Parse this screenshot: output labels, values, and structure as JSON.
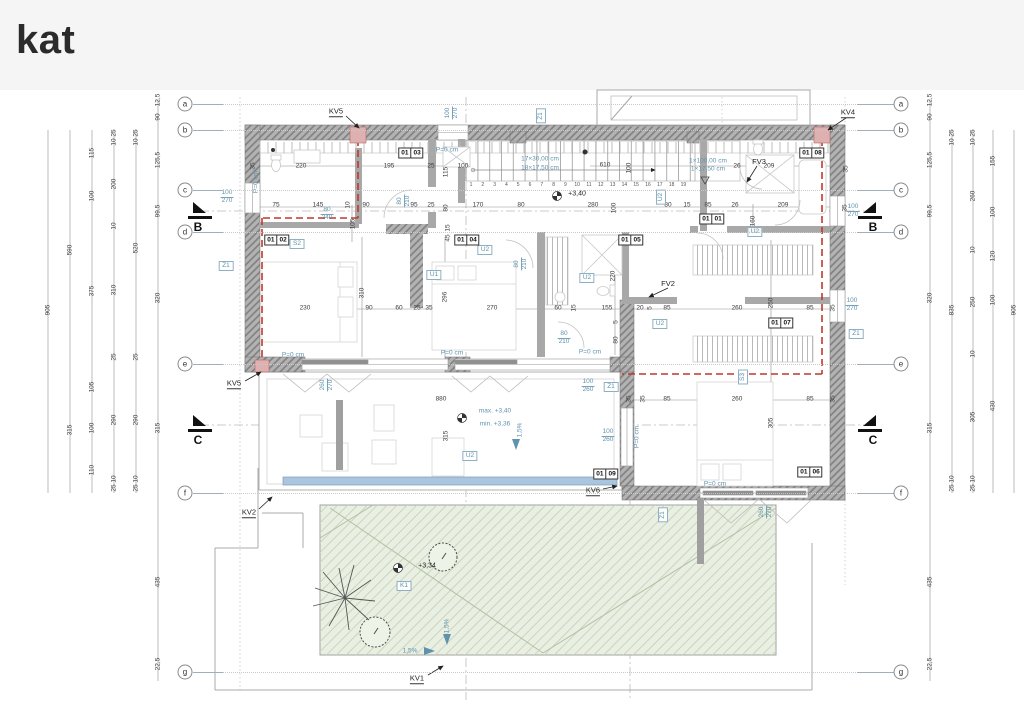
{
  "title": "kat",
  "colors": {
    "accent_blue": "#5f93ad",
    "red_dashed": "#c0392b",
    "green_roof": "#e9efe2",
    "glass_strip": "#aac6df",
    "wall_gray": "#b3b3b3"
  },
  "grid": {
    "rows": [
      {
        "l": "a",
        "y": 104
      },
      {
        "l": "b",
        "y": 130
      },
      {
        "l": "c",
        "y": 190
      },
      {
        "l": "d",
        "y": 232
      },
      {
        "l": "e",
        "y": 364
      },
      {
        "l": "f",
        "y": 493
      },
      {
        "l": "g",
        "y": 672
      }
    ],
    "left_x": 185,
    "right_x": 901
  },
  "stairs": {
    "numbers": [
      "1",
      "2",
      "3",
      "4",
      "5",
      "6",
      "7",
      "8",
      "9",
      "10",
      "11",
      "12",
      "13",
      "14",
      "15",
      "16",
      "17",
      "18",
      "19"
    ],
    "x0": 471,
    "dx": 11.8,
    "y": 185
  },
  "annotations": {
    "dims": [
      [
        "905",
        48,
        310,
        1
      ],
      [
        "590",
        70,
        250,
        1
      ],
      [
        "315",
        70,
        430,
        1
      ],
      [
        "115",
        92,
        153,
        1
      ],
      [
        "100",
        92,
        196,
        1
      ],
      [
        "375",
        92,
        291,
        1
      ],
      [
        "105",
        92,
        387,
        1
      ],
      [
        "100",
        92,
        428,
        1
      ],
      [
        "110",
        92,
        470,
        1
      ],
      [
        "25",
        114,
        133,
        1
      ],
      [
        "10",
        114,
        142,
        1
      ],
      [
        "200",
        114,
        184,
        1
      ],
      [
        "10",
        114,
        226,
        1
      ],
      [
        "310",
        114,
        290,
        1
      ],
      [
        "25",
        114,
        357,
        1
      ],
      [
        "290",
        114,
        420,
        1
      ],
      [
        "10",
        114,
        479,
        1
      ],
      [
        "25",
        114,
        488,
        1
      ],
      [
        "25",
        136,
        133,
        1
      ],
      [
        "10",
        136,
        142,
        1
      ],
      [
        "520",
        136,
        248,
        1
      ],
      [
        "25",
        136,
        357,
        1
      ],
      [
        "290",
        136,
        420,
        1
      ],
      [
        "10",
        136,
        479,
        1
      ],
      [
        "25",
        136,
        488,
        1
      ],
      [
        "12,5",
        158,
        100,
        1
      ],
      [
        "90",
        158,
        117,
        1
      ],
      [
        "125,5",
        158,
        160,
        1
      ],
      [
        "99,5",
        158,
        211,
        1
      ],
      [
        "320",
        158,
        298,
        1
      ],
      [
        "315",
        158,
        428,
        1
      ],
      [
        "435",
        158,
        582,
        1
      ],
      [
        "22,5",
        158,
        664,
        1
      ],
      [
        "12,5",
        930,
        100,
        1
      ],
      [
        "90",
        930,
        117,
        1
      ],
      [
        "125,5",
        930,
        160,
        1
      ],
      [
        "99,5",
        930,
        211,
        1
      ],
      [
        "320",
        930,
        298,
        1
      ],
      [
        "315",
        930,
        428,
        1
      ],
      [
        "435",
        930,
        582,
        1
      ],
      [
        "22,5",
        930,
        664,
        1
      ],
      [
        "25",
        952,
        133,
        1
      ],
      [
        "10",
        952,
        142,
        1
      ],
      [
        "835",
        952,
        310,
        1
      ],
      [
        "10",
        952,
        479,
        1
      ],
      [
        "25",
        952,
        488,
        1
      ],
      [
        "25",
        973,
        133,
        1
      ],
      [
        "10",
        973,
        142,
        1
      ],
      [
        "260",
        973,
        196,
        1
      ],
      [
        "10",
        973,
        250,
        1
      ],
      [
        "250",
        973,
        302,
        1
      ],
      [
        "10",
        973,
        354,
        1
      ],
      [
        "305",
        973,
        417,
        1
      ],
      [
        "10",
        973,
        479,
        1
      ],
      [
        "25",
        973,
        488,
        1
      ],
      [
        "155",
        993,
        161,
        1
      ],
      [
        "100",
        993,
        212,
        1
      ],
      [
        "120",
        993,
        256,
        1
      ],
      [
        "100",
        993,
        300,
        1
      ],
      [
        "430",
        993,
        406,
        1
      ],
      [
        "905",
        1014,
        310,
        1
      ],
      [
        "35",
        253,
        166,
        1
      ],
      [
        "220",
        301,
        166,
        0
      ],
      [
        "195",
        389,
        166,
        0
      ],
      [
        "25",
        431,
        166,
        0
      ],
      [
        "115",
        446,
        172,
        1
      ],
      [
        "100",
        463,
        166,
        0
      ],
      [
        "610",
        605,
        165,
        0
      ],
      [
        "100",
        629,
        168,
        1
      ],
      [
        "26",
        737,
        166,
        0
      ],
      [
        "209",
        769,
        166,
        0
      ],
      [
        "35",
        846,
        169,
        1
      ],
      [
        "75",
        276,
        205,
        0
      ],
      [
        "145",
        318,
        205,
        0
      ],
      [
        "10",
        348,
        205,
        1
      ],
      [
        "90",
        366,
        205,
        0
      ],
      [
        "95",
        414,
        205,
        0
      ],
      [
        "25",
        431,
        205,
        0
      ],
      [
        "80",
        446,
        208,
        1
      ],
      [
        "170",
        478,
        205,
        0
      ],
      [
        "80",
        521,
        205,
        0
      ],
      [
        "280",
        593,
        205,
        0
      ],
      [
        "100",
        614,
        208,
        1
      ],
      [
        "80",
        668,
        205,
        0
      ],
      [
        "15",
        687,
        205,
        0
      ],
      [
        "85",
        708,
        205,
        0
      ],
      [
        "26",
        735,
        205,
        0
      ],
      [
        "209",
        783,
        205,
        0
      ],
      [
        "35",
        845,
        208,
        1
      ],
      [
        "160",
        753,
        221,
        1
      ],
      [
        "105",
        353,
        224,
        1
      ],
      [
        "15",
        448,
        228,
        1
      ],
      [
        "45",
        448,
        238,
        1
      ],
      [
        "220",
        613,
        276,
        1
      ],
      [
        "296",
        445,
        297,
        1
      ],
      [
        "310",
        362,
        293,
        1
      ],
      [
        "250",
        771,
        303,
        1
      ],
      [
        "5",
        616,
        322,
        1
      ],
      [
        "80",
        616,
        340,
        1
      ],
      [
        "305",
        771,
        423,
        1
      ],
      [
        "315",
        446,
        436,
        1
      ],
      [
        "230",
        305,
        308,
        0
      ],
      [
        "90",
        369,
        308,
        0
      ],
      [
        "60",
        399,
        308,
        0
      ],
      [
        "25",
        417,
        308,
        0
      ],
      [
        "35",
        429,
        308,
        0
      ],
      [
        "270",
        492,
        308,
        0
      ],
      [
        "60",
        558,
        308,
        0
      ],
      [
        "15",
        574,
        308,
        1
      ],
      [
        "155",
        607,
        308,
        0
      ],
      [
        "20",
        640,
        308,
        0
      ],
      [
        "5",
        650,
        308,
        1
      ],
      [
        "85",
        667,
        308,
        0
      ],
      [
        "260",
        737,
        308,
        0
      ],
      [
        "85",
        810,
        308,
        0
      ],
      [
        "35",
        833,
        308,
        1
      ],
      [
        "880",
        441,
        399,
        0
      ],
      [
        "35",
        629,
        399,
        1
      ],
      [
        "35",
        643,
        399,
        1
      ],
      [
        "85",
        667,
        399,
        0
      ],
      [
        "260",
        737,
        399,
        0
      ],
      [
        "85",
        810,
        399,
        0
      ],
      [
        "35",
        833,
        399,
        1
      ]
    ],
    "blue_fracs": [
      [
        "100",
        "270",
        227,
        197,
        0
      ],
      [
        "100",
        "270",
        452,
        113,
        1
      ],
      [
        "100",
        "270",
        853,
        211,
        0
      ],
      [
        "100",
        "270",
        852,
        305,
        0
      ],
      [
        "100",
        "260",
        588,
        386,
        0
      ],
      [
        "100",
        "260",
        608,
        436,
        0
      ],
      [
        "80",
        "210",
        404,
        201,
        1
      ],
      [
        "80",
        "210",
        521,
        264,
        1
      ],
      [
        "80",
        "210",
        564,
        338,
        0
      ],
      [
        "80",
        "240",
        327,
        214,
        0
      ],
      [
        "260",
        "270",
        766,
        512,
        1
      ],
      [
        "260",
        "270",
        327,
        385,
        1
      ]
    ],
    "blue_texts": [
      [
        "P=0 cm",
        256,
        182,
        1
      ],
      [
        "P=0 cm",
        447,
        150,
        0
      ],
      [
        "P=0 cm",
        293,
        355,
        0
      ],
      [
        "P=0 cm",
        452,
        353,
        0
      ],
      [
        "P=0 cm",
        590,
        352,
        0
      ],
      [
        "P=0 cm",
        715,
        484,
        0
      ],
      [
        "P=0 cm",
        637,
        437,
        1
      ],
      [
        "1,5%",
        520,
        430,
        1
      ],
      [
        "1,5%",
        447,
        626,
        1
      ],
      [
        "1,5%",
        410,
        651,
        0
      ],
      [
        "17×30,00 cm",
        540,
        159,
        0
      ],
      [
        "18×17,50 cm",
        540,
        168,
        0
      ],
      [
        "1×100,00 cm",
        708,
        161,
        0
      ],
      [
        "1×17,50 cm",
        708,
        169,
        0
      ],
      [
        "max. +3,40",
        495,
        411,
        0
      ],
      [
        "min. +3,36",
        495,
        424,
        0
      ]
    ],
    "black_texts": [
      [
        "+3,40",
        577,
        194
      ],
      [
        "+3,34",
        427,
        566
      ]
    ],
    "blue_boxes": [
      [
        "U1",
        434,
        275,
        0
      ],
      [
        "U2",
        485,
        250,
        0
      ],
      [
        "U2",
        587,
        278,
        0
      ],
      [
        "U2",
        661,
        197,
        1
      ],
      [
        "U2",
        660,
        324,
        0
      ],
      [
        "U2",
        755,
        232,
        0
      ],
      [
        "U2",
        470,
        456,
        0
      ],
      [
        "S2",
        297,
        244,
        0
      ],
      [
        "S3",
        743,
        377,
        1
      ],
      [
        "Z1",
        226,
        266,
        0
      ],
      [
        "Z1",
        541,
        116,
        1
      ],
      [
        "Z1",
        611,
        387,
        0
      ],
      [
        "Z1",
        856,
        334,
        0
      ],
      [
        "Z1",
        663,
        515,
        1
      ],
      [
        "K1",
        404,
        586,
        0
      ]
    ],
    "room_tags": [
      [
        "01",
        "01",
        712,
        219
      ],
      [
        "01",
        "02",
        277,
        240
      ],
      [
        "01",
        "03",
        411,
        153
      ],
      [
        "01",
        "04",
        467,
        240
      ],
      [
        "01",
        "05",
        631,
        240
      ],
      [
        "01",
        "06",
        810,
        472
      ],
      [
        "01",
        "07",
        781,
        323
      ],
      [
        "01",
        "08",
        812,
        153
      ],
      [
        "01",
        "09",
        606,
        474
      ]
    ],
    "kv_labels": [
      [
        "KV5",
        336,
        112
      ],
      [
        "KV4",
        848,
        113
      ],
      [
        "KV5",
        234,
        384
      ],
      [
        "KV2",
        249,
        513
      ],
      [
        "KV6",
        593,
        491
      ],
      [
        "KV1",
        417,
        679
      ]
    ],
    "fv_labels": [
      [
        "FV2",
        668,
        284
      ],
      [
        "FV3",
        759,
        162
      ]
    ],
    "sections": [
      [
        "B",
        "l",
        213
      ],
      [
        "B",
        "r",
        213
      ],
      [
        "C",
        "l",
        426
      ],
      [
        "C",
        "r",
        426
      ]
    ]
  }
}
